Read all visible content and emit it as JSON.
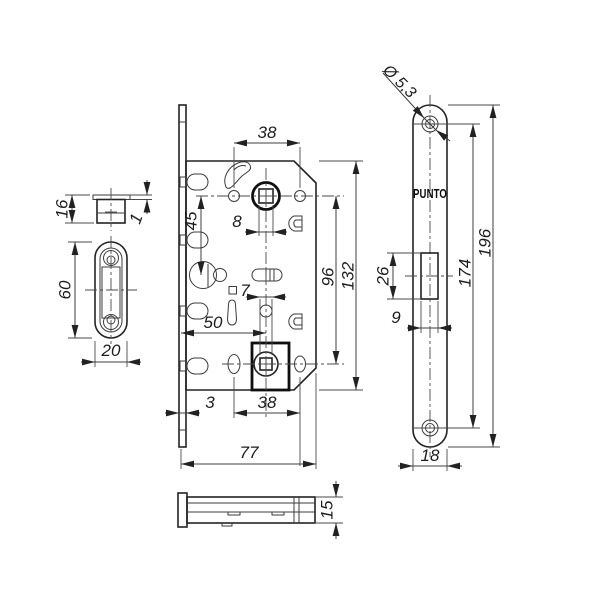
{
  "brand": {
    "label": "PUNTO"
  },
  "dims": {
    "strike_box_height": "16",
    "strike_box_flange": "1",
    "strike_plate_height": "60",
    "strike_plate_width": "20",
    "top_hole_span": "38",
    "hub_to_cylinder": "45",
    "hub_square": "8",
    "hub_span": "96",
    "case_height": "132",
    "wc_square": "7",
    "backset": "50",
    "faceplate_standoff": "3",
    "bottom_hole_span": "38",
    "case_depth": "77",
    "screw_hole_dia": "Ø 5,3",
    "screw_span": "174",
    "faceplate_length": "196",
    "latch_cutout_height": "26",
    "latch_cutout_width": "9",
    "faceplate_width": "18",
    "case_thickness": "15"
  }
}
